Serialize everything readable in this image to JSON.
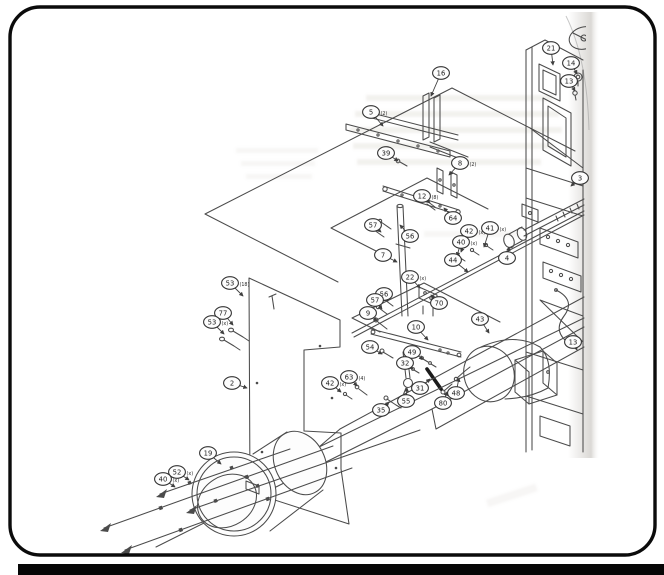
{
  "page": {
    "kind": "scanned service-manual exploded parts diagram",
    "border_color": "#0b0b0b",
    "ink_color": "#4b4b4b",
    "paper_color": "#ffffff",
    "bottom_bar_color": "#060606"
  },
  "callouts": [
    {
      "label": "16",
      "suffix": "",
      "cx": 441,
      "cy": 73,
      "tx": 431,
      "ty": 96
    },
    {
      "label": "5",
      "suffix": "(2)",
      "cx": 371,
      "cy": 112,
      "tx": 383,
      "ty": 126
    },
    {
      "label": "39",
      "suffix": "",
      "cx": 386,
      "cy": 153,
      "tx": 398,
      "ty": 161
    },
    {
      "label": "8",
      "suffix": "(2)",
      "cx": 460,
      "cy": 163,
      "tx": 449,
      "ty": 175
    },
    {
      "label": "12",
      "suffix": "(8)",
      "cx": 422,
      "cy": 196,
      "tx": 430,
      "ty": 203
    },
    {
      "label": "64",
      "suffix": "",
      "cx": 453,
      "cy": 218,
      "tx": 444,
      "ty": 208
    },
    {
      "label": "57",
      "suffix": "",
      "cx": 373,
      "cy": 225,
      "tx": 381,
      "ty": 232
    },
    {
      "label": "56",
      "suffix": "",
      "cx": 410,
      "cy": 236,
      "tx": 400,
      "ty": 225
    },
    {
      "label": "7",
      "suffix": "",
      "cx": 383,
      "cy": 255,
      "tx": 397,
      "ty": 262
    },
    {
      "label": "42",
      "suffix": "(x)",
      "cx": 469,
      "cy": 231,
      "tx": 461,
      "ty": 252
    },
    {
      "label": "41",
      "suffix": "(x)",
      "cx": 490,
      "cy": 228,
      "tx": 484,
      "ty": 247
    },
    {
      "label": "40",
      "suffix": "(x)",
      "cx": 461,
      "cy": 242,
      "tx": 457,
      "ty": 256
    },
    {
      "label": "44",
      "suffix": "",
      "cx": 453,
      "cy": 260,
      "tx": 468,
      "ty": 272
    },
    {
      "label": "4",
      "suffix": "",
      "cx": 507,
      "cy": 258,
      "tx": 509,
      "ty": 247
    },
    {
      "label": "22",
      "suffix": "(x)",
      "cx": 410,
      "cy": 277,
      "tx": 420,
      "ty": 288
    },
    {
      "label": "56",
      "suffix": "",
      "cx": 384,
      "cy": 294,
      "tx": 388,
      "ty": 301
    },
    {
      "label": "57",
      "suffix": "",
      "cx": 375,
      "cy": 300,
      "tx": 382,
      "ty": 309
    },
    {
      "label": "70",
      "suffix": "",
      "cx": 439,
      "cy": 303,
      "tx": 431,
      "ty": 295
    },
    {
      "label": "9",
      "suffix": "",
      "cx": 368,
      "cy": 313,
      "tx": 377,
      "ty": 321
    },
    {
      "label": "10",
      "suffix": "",
      "cx": 416,
      "cy": 327,
      "tx": 428,
      "ty": 340
    },
    {
      "label": "54",
      "suffix": "",
      "cx": 370,
      "cy": 347,
      "tx": 382,
      "ty": 354
    },
    {
      "label": "49",
      "suffix": "",
      "cx": 412,
      "cy": 352,
      "tx": 423,
      "ty": 359
    },
    {
      "label": "32",
      "suffix": "",
      "cx": 405,
      "cy": 363,
      "tx": 413,
      "ty": 369
    },
    {
      "label": "31",
      "suffix": "",
      "cx": 420,
      "cy": 388,
      "tx": 430,
      "ty": 379
    },
    {
      "label": "55",
      "suffix": "",
      "cx": 406,
      "cy": 401,
      "tx": 407,
      "ty": 388
    },
    {
      "label": "35",
      "suffix": "",
      "cx": 381,
      "cy": 410,
      "tx": 389,
      "ty": 402
    },
    {
      "label": "80",
      "suffix": "",
      "cx": 443,
      "cy": 403,
      "tx": 447,
      "ty": 392
    },
    {
      "label": "48",
      "suffix": "",
      "cx": 456,
      "cy": 393,
      "tx": 459,
      "ty": 378
    },
    {
      "label": "43",
      "suffix": "",
      "cx": 480,
      "cy": 319,
      "tx": 489,
      "ty": 333
    },
    {
      "label": "63",
      "suffix": "(4)",
      "cx": 349,
      "cy": 377,
      "tx": 357,
      "ty": 386
    },
    {
      "label": "42",
      "suffix": "(x)",
      "cx": 330,
      "cy": 383,
      "tx": 341,
      "ty": 392
    },
    {
      "label": "2",
      "suffix": "",
      "cx": 232,
      "cy": 383,
      "tx": 247,
      "ty": 388
    },
    {
      "label": "53",
      "suffix": "(18)",
      "cx": 230,
      "cy": 283,
      "tx": 243,
      "ty": 296
    },
    {
      "label": "77",
      "suffix": "",
      "cx": 223,
      "cy": 313,
      "tx": 233,
      "ty": 325
    },
    {
      "label": "53",
      "suffix": "(x)",
      "cx": 212,
      "cy": 322,
      "tx": 224,
      "ty": 334
    },
    {
      "label": "19",
      "suffix": "",
      "cx": 208,
      "cy": 453,
      "tx": 221,
      "ty": 464
    },
    {
      "label": "52",
      "suffix": "(x)",
      "cx": 177,
      "cy": 472,
      "tx": 189,
      "ty": 480
    },
    {
      "label": "40",
      "suffix": "(x)",
      "cx": 163,
      "cy": 479,
      "tx": 175,
      "ty": 487
    },
    {
      "label": "21",
      "suffix": "",
      "cx": 551,
      "cy": 48,
      "tx": 553,
      "ty": 65
    },
    {
      "label": "14",
      "suffix": "",
      "cx": 571,
      "cy": 63,
      "tx": 577,
      "ty": 74
    },
    {
      "label": "13",
      "suffix": "",
      "cx": 569,
      "cy": 81,
      "tx": 575,
      "ty": 91
    },
    {
      "label": "3",
      "suffix": "",
      "cx": 580,
      "cy": 178,
      "tx": 571,
      "ty": 186
    },
    {
      "label": "13",
      "suffix": "",
      "cx": 573,
      "cy": 342,
      "tx": 577,
      "ty": 350
    }
  ]
}
